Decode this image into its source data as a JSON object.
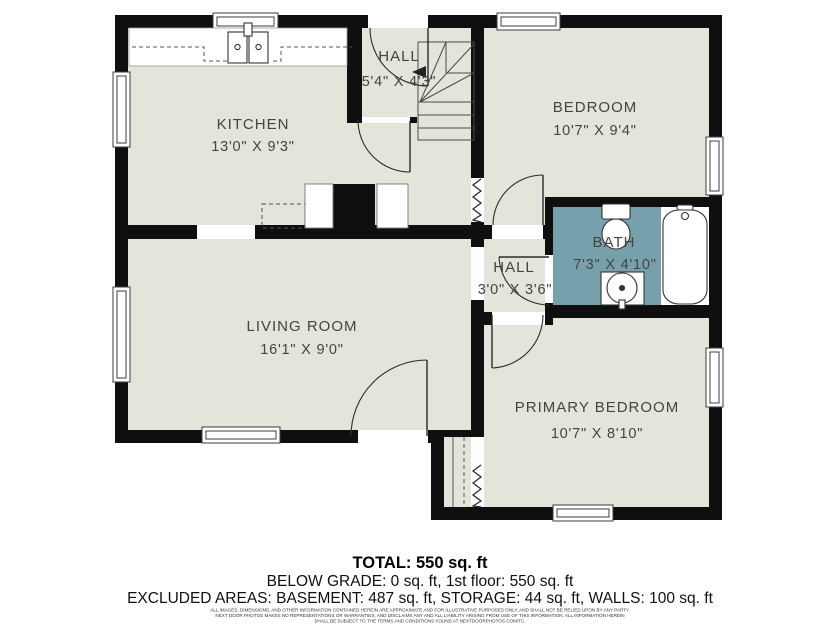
{
  "colors": {
    "floor": "#e5e4da",
    "bath_floor": "#76a1ac",
    "wall": "#0f0f0f",
    "label": "#45443e"
  },
  "rooms": {
    "kitchen": {
      "name": "KITCHEN",
      "dims": "13'0\" X 9'3\""
    },
    "hall_top": {
      "name": "HALL",
      "dims": "5'4\" X 4'3\""
    },
    "bedroom": {
      "name": "BEDROOM",
      "dims": "10'7\" X 9'4\""
    },
    "bath": {
      "name": "BATH",
      "dims": "7'3\" X 4'10\""
    },
    "hall_mid": {
      "name": "HALL",
      "dims": "3'0\" X 3'6\""
    },
    "living_room": {
      "name": "LIVING ROOM",
      "dims": "16'1\" X 9'0\""
    },
    "primary_bedroom": {
      "name": "PRIMARY BEDROOM",
      "dims": "10'7\" X 8'10\""
    }
  },
  "summary": {
    "total": "TOTAL: 550 sq. ft",
    "below_grade": "BELOW GRADE: 0 sq. ft, 1st floor: 550 sq. ft",
    "excluded": "EXCLUDED AREAS: BASEMENT: 487 sq. ft, STORAGE: 44 sq. ft, WALLS: 100 sq. ft"
  },
  "disclaimer": {
    "line1": "ALL IMAGES, DIMENSIONS, AND OTHER INFORMATION CONTAINED HEREIN ARE APPROXIMATE AND FOR ILLUSTRATIVE PURPOSES ONLY, AND SHALL NOT BE RELIED UPON BY ANY PARTY.",
    "line2": "NEXT DOOR PHOTOS MAKES NO REPRESENTATIONS OR WARRANTIES, AND DISCLAIMS ANY AND ALL LIABILITY ARISING FROM USE OF THIS INFORMATION. ALL INFORMATION HEREIN",
    "line3": "SHALL BE SUBJECT TO THE TERMS AND CONDITIONS FOUND AT NEXTDOORPHOTOS.COM/TC."
  }
}
